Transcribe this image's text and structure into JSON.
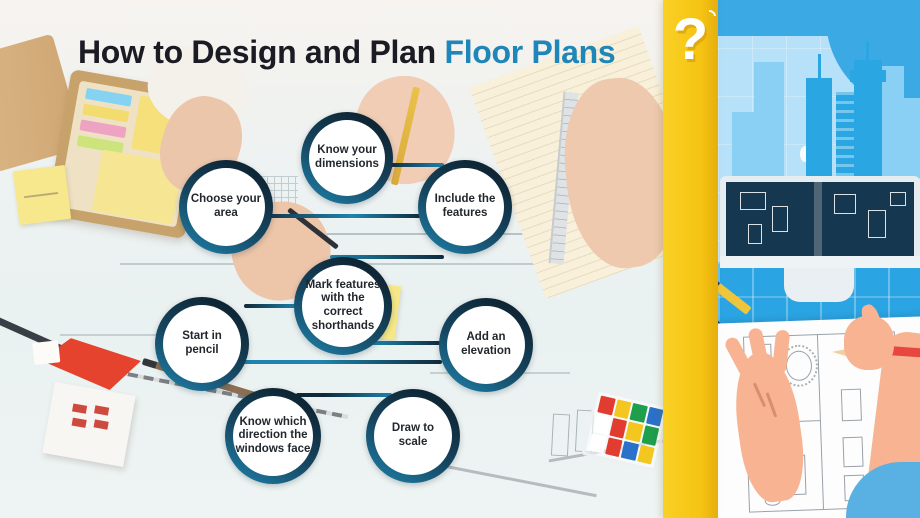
{
  "title": {
    "prefix": "How to Design and Plan ",
    "highlight": "Floor Plans"
  },
  "steps": [
    {
      "label": "Know your dimensions"
    },
    {
      "label": "Choose your area"
    },
    {
      "label": "Include the features"
    },
    {
      "label": "Mark features with the correct shorthands"
    },
    {
      "label": "Start in pencil"
    },
    {
      "label": "Add an elevation"
    },
    {
      "label": "Know which direction the windows face"
    },
    {
      "label": "Draw to scale"
    }
  ],
  "accent": {
    "question_mark": "?"
  },
  "colors": {
    "accent_yellow": "#F5C312",
    "title_dark": "#1A1B23",
    "title_highlight": "#1E86B8",
    "step_ring_dark": "#10293A",
    "step_ring_teal": "#1E84AE",
    "illustration_blue": "#2AA4E2",
    "sky_blue": "#B7E1F8",
    "wave_blue": "#3BA9E4"
  }
}
